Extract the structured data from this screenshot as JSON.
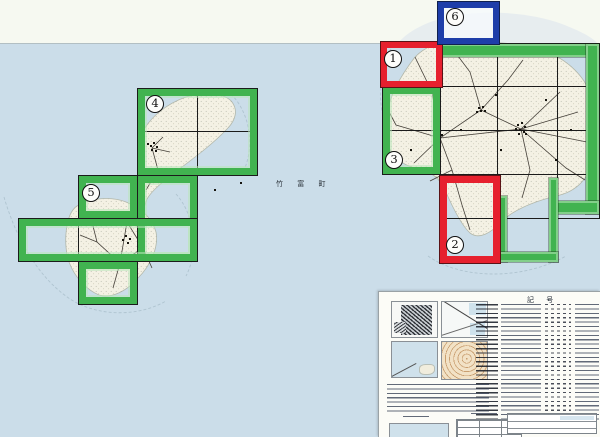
{
  "map": {
    "municipality_label": "竹 富 町",
    "sheet_markers": [
      {
        "num": "1"
      },
      {
        "num": "2"
      },
      {
        "num": "3"
      },
      {
        "num": "4"
      },
      {
        "num": "5"
      },
      {
        "num": "6"
      }
    ]
  },
  "legend": {
    "title": "記 号"
  },
  "colors": {
    "sea": "#cbdde9",
    "sheet_margin": "#f6f9f1",
    "land": "#f4f1e4",
    "coverage_green": "#41b350",
    "selected_red": "#e6202e",
    "selected_blue": "#1e3ea9"
  }
}
